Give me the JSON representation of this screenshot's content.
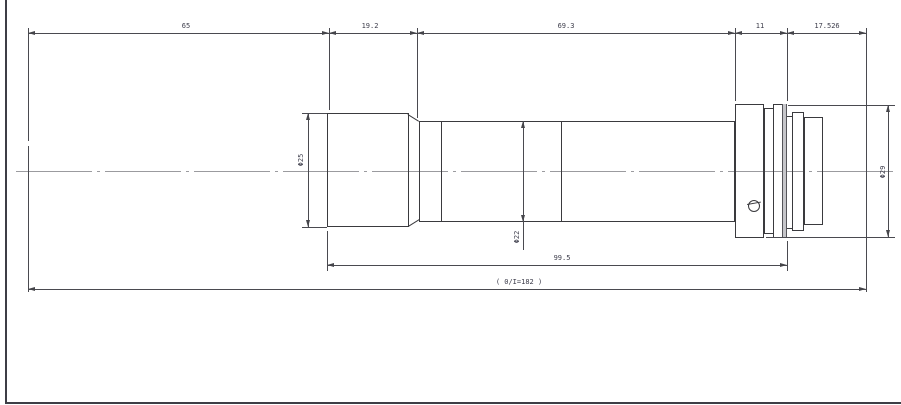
{
  "dims": {
    "top": [
      "65",
      "19.2",
      "69.3",
      "11",
      "17.526"
    ],
    "length": "99.5",
    "overall": "( 0/I=182 )",
    "dia_front": "Φ25",
    "dia_barrel": "Φ22",
    "dia_flange": "Φ29"
  },
  "colors": {
    "line": "#3a3a3e",
    "dimension": "#4a4a50",
    "centerline": "#9b9b9f",
    "background": "#ffffff"
  }
}
